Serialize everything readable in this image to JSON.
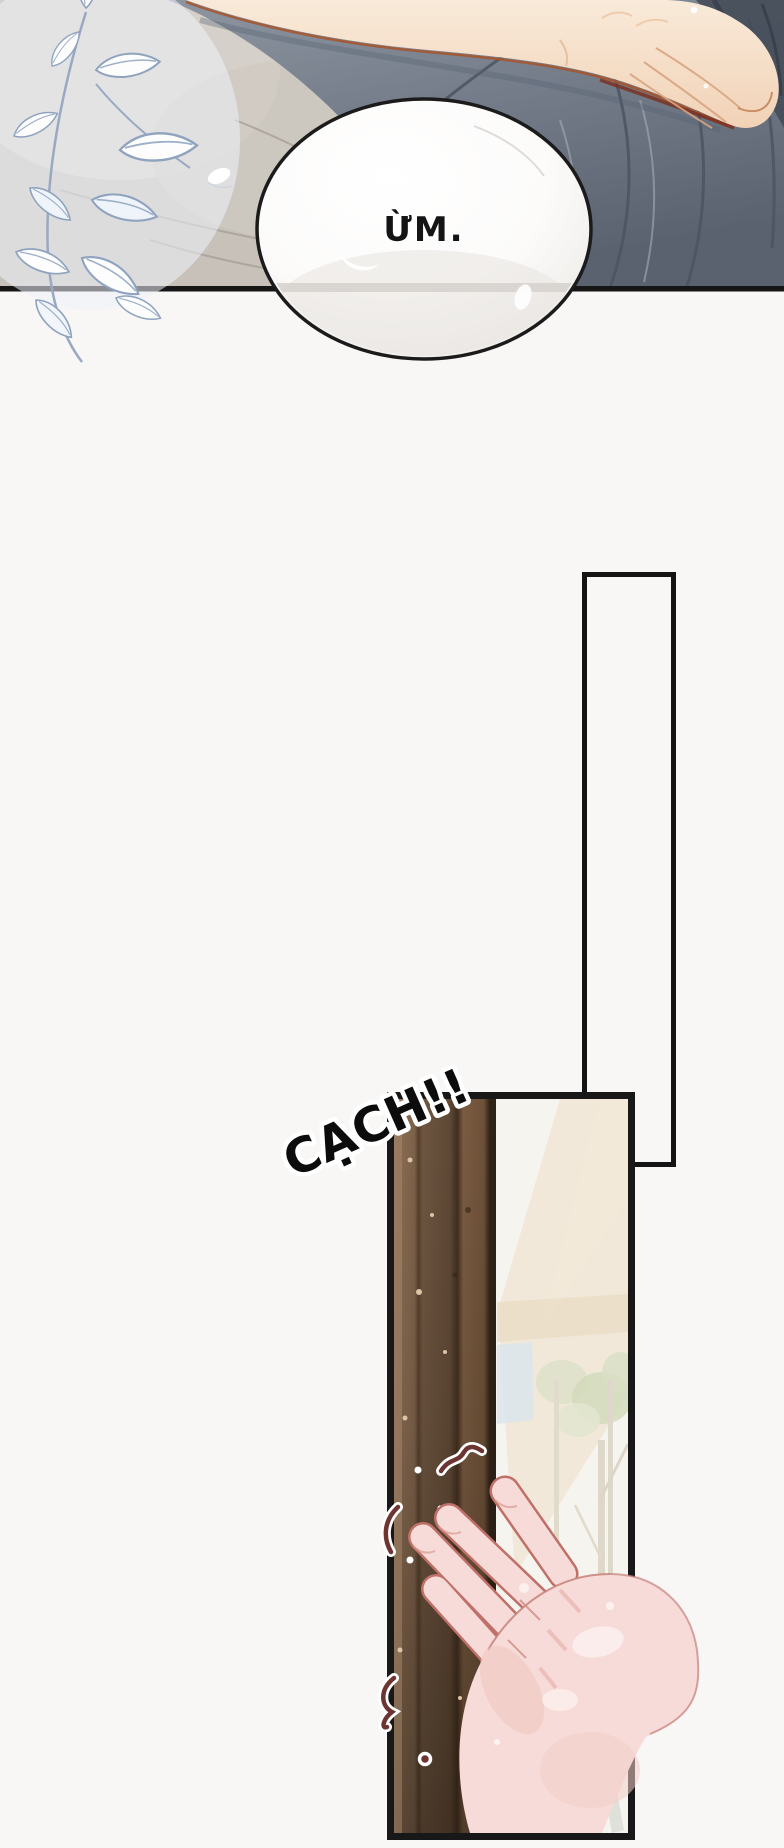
{
  "page": {
    "background": "#f8f7f6",
    "panel_border_color": "#161616"
  },
  "panels": {
    "bed_scene": {
      "alt": "hand resting on grey bedding with white leaf spray"
    },
    "door_frame": {
      "alt": "tall empty door frame outline"
    },
    "door_opening": {
      "alt": "hand gripping the edge of a brown wooden door"
    }
  },
  "speech_bubble": {
    "text": "ỪM.",
    "text_color": "#141414",
    "fill": "#ffffff",
    "border": "#1b1b1b"
  },
  "sfx": {
    "text": "CẠCH!!",
    "fill": "#0c0c0c",
    "outline": "#ffffff"
  },
  "palette": {
    "fabric_beige": "#c7c1ba",
    "fabric_slate": "#757d8a",
    "fabric_slate_dark": "#4a515e",
    "skin": "#f6e0cc",
    "skin_outline": "#a5562f",
    "leaf_outline": "#8fa3bf",
    "wood_light": "#8d7057",
    "wood_dark": "#2f2216",
    "door_interior": "#f6f4ee",
    "hand_pink": "#f7dbd8",
    "hand_outline": "#bf7068",
    "squiggle_red": "#6d3431",
    "chair_grey": "#c6cac5"
  }
}
